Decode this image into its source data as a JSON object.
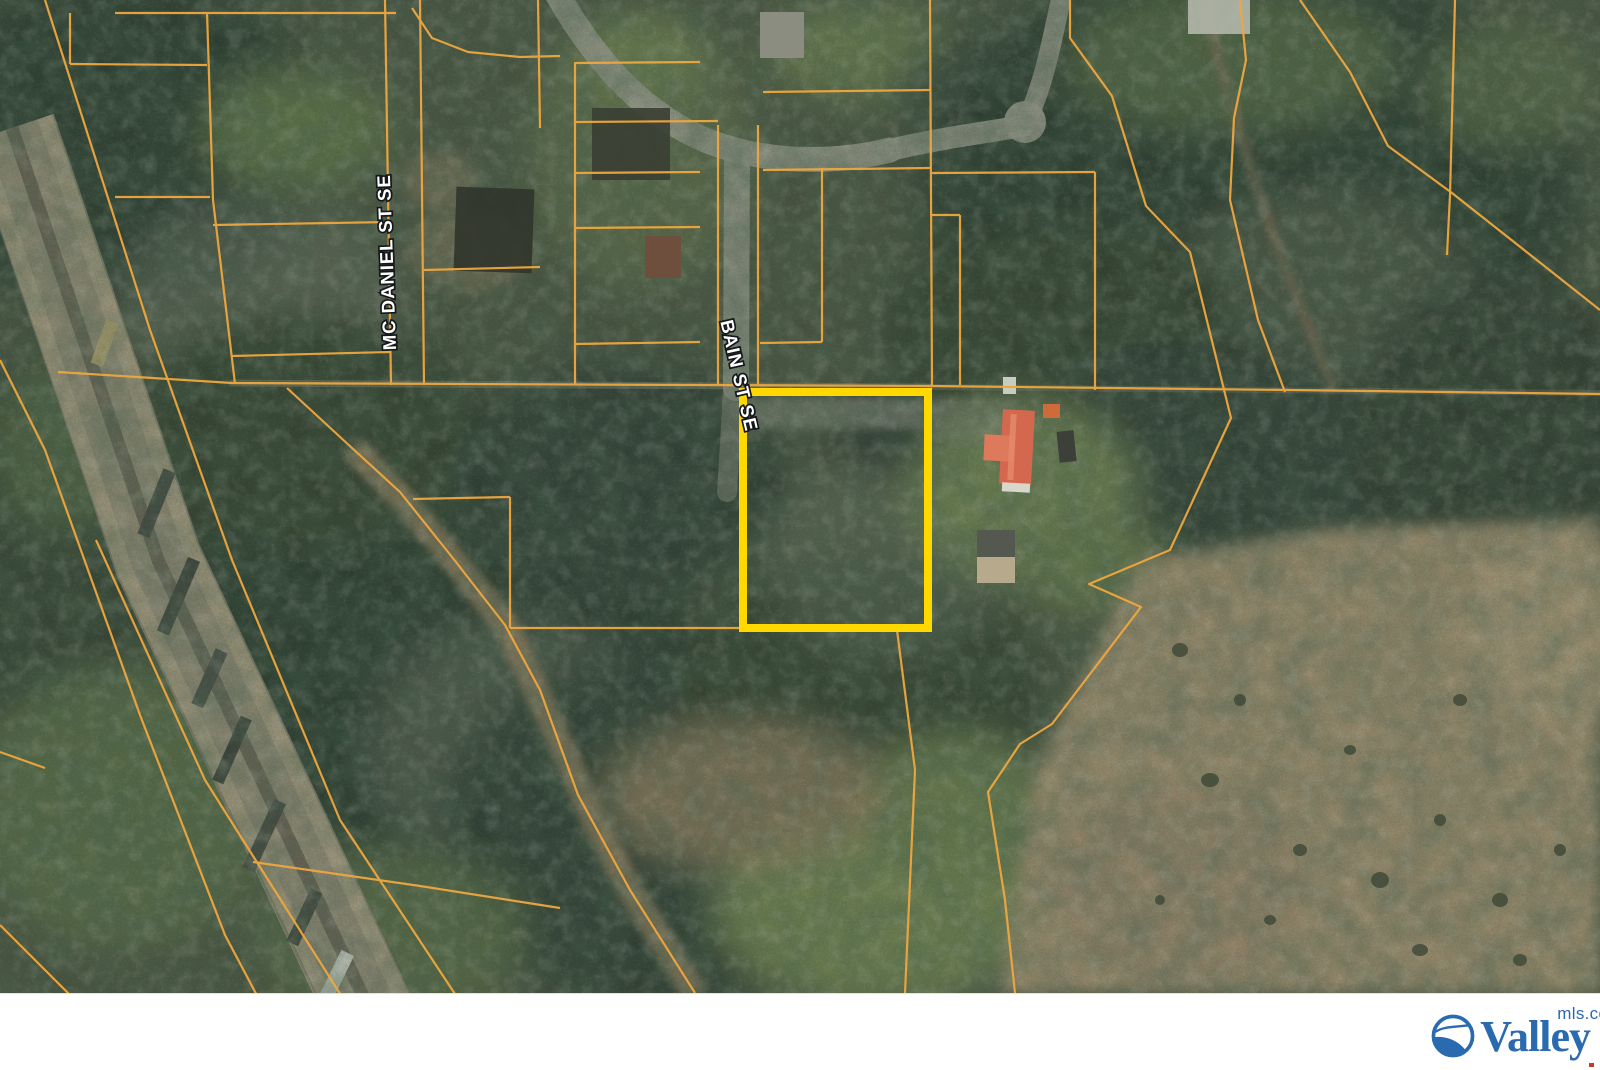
{
  "map": {
    "street_labels": {
      "mc_daniel": "MC DANIEL ST SE",
      "bain": "BAIN ST SE"
    },
    "parcel_line_color": "#EFA73E",
    "highlight_color": "#FFD800"
  },
  "footer": {
    "logo_word": "Valley",
    "logo_suffix": "mls.com",
    "logo_color": "#2A6AAE"
  }
}
